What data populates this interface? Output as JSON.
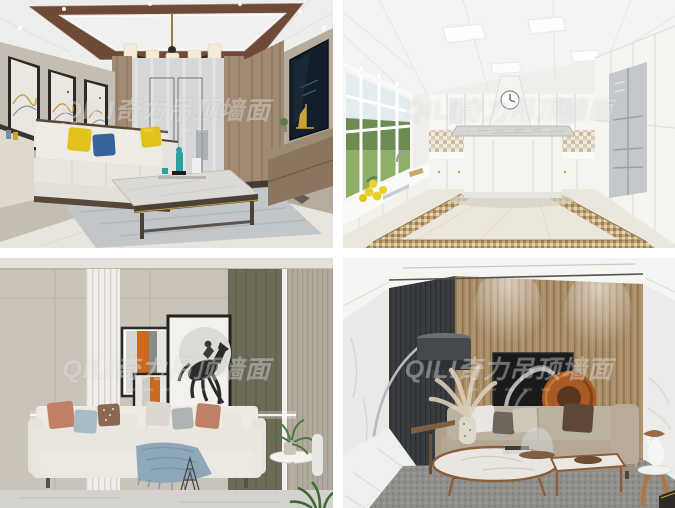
{
  "app": {
    "name": "interior-design-photo-grid"
  },
  "watermark": {
    "text": "QILI奇力吊顶墙面",
    "color": "#ffffff",
    "opacity": 0.33
  },
  "gallery": {
    "images": [
      {
        "id": "living-room-coffered-ceiling",
        "label": "Living room with wood coffered ceiling, chandelier, triple abstract art, white sofa with yellow and blue pillows, marble coffee table and wall TV"
      },
      {
        "id": "white-kitchen-u-shape",
        "label": "White U-shaped kitchen with LED panel ceiling, garden windows, mosaic backsplash, range hood with clock, island and mosaic floor border"
      },
      {
        "id": "living-room-horse-art",
        "label": "Beige living room with white slat panel, leaping horse artwork with orange stripes, cream sofa with pastel pillows and round side table"
      },
      {
        "id": "living-room-wood-slat-wall",
        "label": "Living room with walnut slat feature wall, dark abstract art with copper circle, arc floor lamp, taupe sofa and round marble coffee tables"
      }
    ]
  },
  "colors": {
    "gutter": "#ffffff",
    "wall_beige": "#c7c0b4",
    "ceiling_wood_band": "#6f4b37",
    "pillow_yellow": "#e2c31a",
    "pillow_blue": "#35639a",
    "art_stripe_orange": "#c96a22",
    "copper_circle": "#a85a22",
    "charcoal_rib_panel": "#3a3d40",
    "wood_slat_wall": "#a98e6a",
    "olive_panel": "#6e6a58",
    "curtain_brown": "#a28a72",
    "mosaic_border_gold": "#c4a97b"
  }
}
